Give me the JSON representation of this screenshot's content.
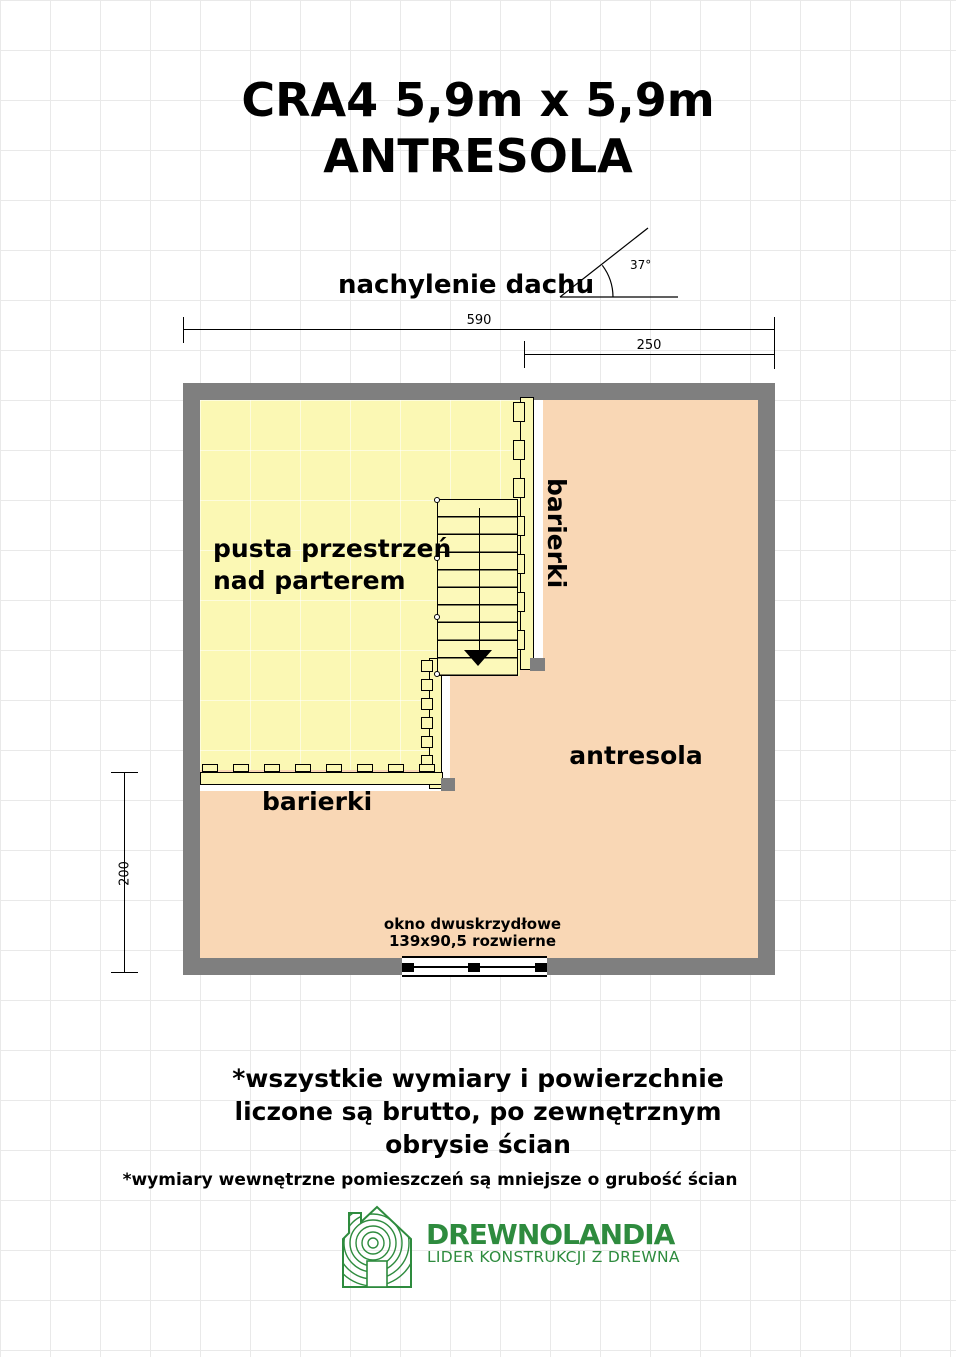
{
  "page": {
    "title_line1": "CRA4 5,9m x 5,9m",
    "title_line2": "ANTRESOLA"
  },
  "roof_pitch": {
    "label": "nachylenie dachu",
    "angle_value": "37°"
  },
  "dimensions": {
    "overall_width": "590",
    "mezzanine_width": "250",
    "left_height": "200"
  },
  "floor_plan": {
    "void_label_line1": "pusta przestrzeń",
    "void_label_line2": "nad parterem",
    "mezzanine_label": "antresola",
    "railing_label_vertical": "barierki",
    "railing_label_horizontal": "barierki",
    "window_label_line1": "okno dwuskrzydłowe",
    "window_label_line2": "139x90,5 rozwierne"
  },
  "notes": {
    "gross_line1": "*wszystkie wymiary i powierzchnie",
    "gross_line2": "liczone są brutto, po zewnętrznym",
    "gross_line3": "obrysie ścian",
    "internal": "*wymiary wewnętrzne pomieszczeń są mniejsze o grubość ścian"
  },
  "brand": {
    "name": "DREWNOLANDIA",
    "tagline": "LIDER KONSTRUKCJI Z DREWNA"
  },
  "colors": {
    "wall_gray": "#7f7f7f",
    "void_fill": "#fbf8b4",
    "mezzanine_fill": "#f9d7b5",
    "brand_green": "#2e8b3e"
  }
}
